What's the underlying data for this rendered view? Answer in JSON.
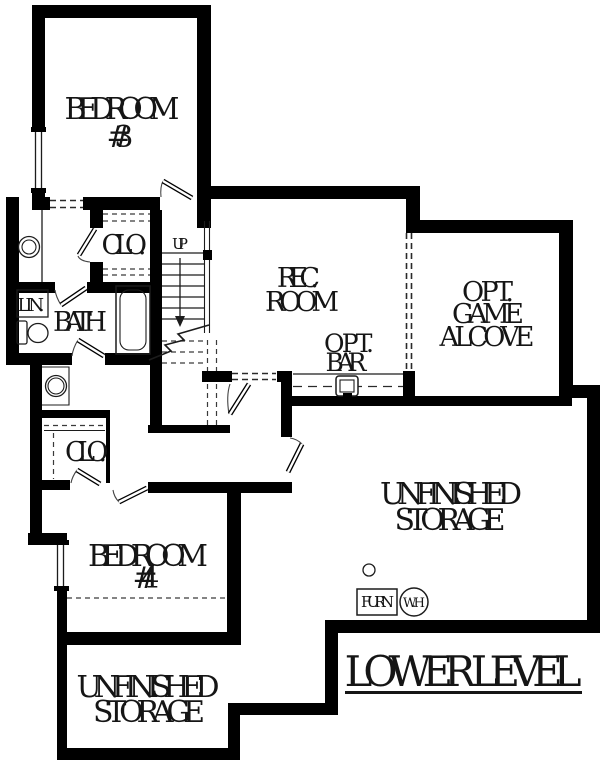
{
  "colors": {
    "wall": "#000000",
    "line": "#1c1c1c",
    "background": "#ffffff"
  },
  "title": {
    "label": "LOWER LEVEL"
  },
  "rooms": {
    "bedroom3": {
      "line1": "BEDROOM",
      "line2": "#3"
    },
    "closet_upper": {
      "label": "CLO."
    },
    "stairs": {
      "label": "UP"
    },
    "rec_room": {
      "line1": "REC.",
      "line2": "ROOM"
    },
    "game_alcove": {
      "line1": "OPT.",
      "line2": "GAME",
      "line3": "ALCOVE"
    },
    "bar": {
      "line1": "OPT.",
      "line2": "BAR"
    },
    "linen": {
      "label": "LIN."
    },
    "bath": {
      "label": "BATH"
    },
    "closet_lower": {
      "label": "CLO."
    },
    "bedroom4": {
      "line1": "BEDROOM",
      "line2": "#4"
    },
    "storage_right": {
      "line1": "UNFINISHED",
      "line2": "STORAGE"
    },
    "storage_left": {
      "line1": "UNFINISHED",
      "line2": "STORAGE"
    }
  },
  "equipment": {
    "furnace": "FURN.",
    "water_heater": "W.H"
  }
}
